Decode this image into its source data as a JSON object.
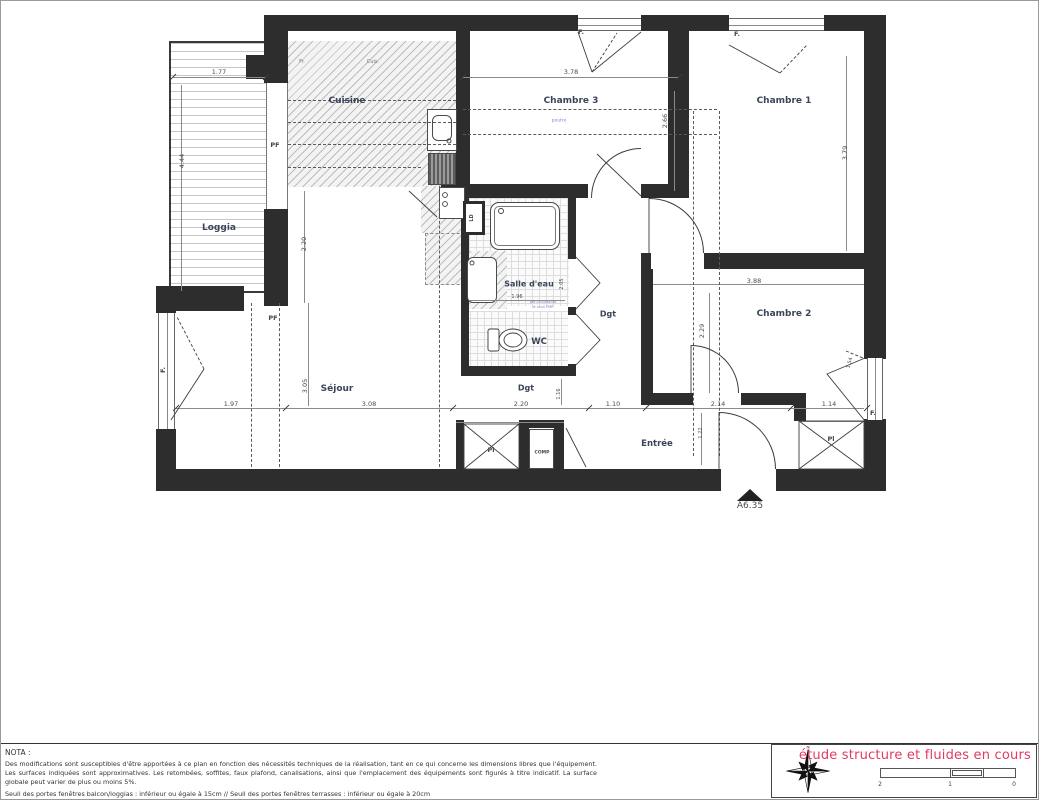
{
  "plan": {
    "labels": [
      {
        "n": "room-label-loggia",
        "t": "Loggia",
        "x": 218,
        "y": 227,
        "c": "room"
      },
      {
        "n": "room-label-cuisine",
        "t": "Cuisine",
        "x": 346,
        "y": 100,
        "c": "room"
      },
      {
        "n": "room-label-chambre3",
        "t": "Chambre 3",
        "x": 570,
        "y": 100,
        "c": "room"
      },
      {
        "n": "room-label-chambre1",
        "t": "Chambre 1",
        "x": 783,
        "y": 100,
        "c": "room"
      },
      {
        "n": "room-label-sejour",
        "t": "Séjour",
        "x": 336,
        "y": 388,
        "c": "room"
      },
      {
        "n": "room-label-salle-deau",
        "t": "Salle d'eau",
        "x": 528,
        "y": 283,
        "c": "room",
        "s": 8
      },
      {
        "n": "room-label-wc",
        "t": "WC",
        "x": 538,
        "y": 341,
        "c": "room",
        "s": 8.5
      },
      {
        "n": "room-label-chambre2",
        "t": "Chambre 2",
        "x": 783,
        "y": 313,
        "c": "room"
      },
      {
        "n": "room-label-entree",
        "t": "Entrée",
        "x": 656,
        "y": 443,
        "c": "room",
        "s": 8.5
      },
      {
        "n": "room-label-dgt-1",
        "t": "Dgt",
        "x": 525,
        "y": 387,
        "c": "room",
        "s": 8
      },
      {
        "n": "room-label-dgt-2",
        "t": "Dgt",
        "x": 607,
        "y": 313,
        "c": "room",
        "s": 8
      },
      {
        "n": "label-pf-1",
        "t": "PF",
        "x": 274,
        "y": 144,
        "c": "small"
      },
      {
        "n": "label-pf-2",
        "t": "PF",
        "x": 272,
        "y": 317,
        "c": "small"
      },
      {
        "n": "label-f-chambre3",
        "t": "F.",
        "x": 580,
        "y": 31,
        "c": "small"
      },
      {
        "n": "label-f-chambre1",
        "t": "F.",
        "x": 736,
        "y": 33,
        "c": "small"
      },
      {
        "n": "label-f-chambre2",
        "t": "F.",
        "x": 872,
        "y": 412,
        "c": "small"
      },
      {
        "n": "label-f-sejour",
        "t": "F.",
        "x": 162,
        "y": 369,
        "c": "small",
        "r": -90
      },
      {
        "n": "label-pl-1",
        "t": "Pl",
        "x": 490,
        "y": 449,
        "c": "small"
      },
      {
        "n": "label-pl-2",
        "t": "Pl",
        "x": 830,
        "y": 438,
        "c": "small"
      },
      {
        "n": "label-comp",
        "t": "COMP",
        "x": 541,
        "y": 452,
        "c": "small",
        "s": 4.5
      },
      {
        "n": "label-ld",
        "t": "LD",
        "x": 471,
        "y": 217,
        "c": "small",
        "s": 5,
        "r": -90
      },
      {
        "n": "label-fr",
        "t": "Fr.",
        "x": 301,
        "y": 61,
        "c": "tiny"
      },
      {
        "n": "label-cuis",
        "t": "Cuis.",
        "x": 372,
        "y": 61,
        "c": "tiny"
      },
      {
        "n": "label-poutre",
        "t": "poutre",
        "x": 558,
        "y": 120,
        "c": "tiny blue",
        "s": 4.5
      },
      {
        "n": "label-porte-note-1",
        "t": "pte coulissante",
        "x": 542,
        "y": 301,
        "c": "tiny blue",
        "s": 3.5
      },
      {
        "n": "label-porte-note-2",
        "t": "et seuil PMR",
        "x": 542,
        "y": 306,
        "c": "tiny blue",
        "s": 3.5
      },
      {
        "n": "label-apartment-ref",
        "t": "A6.35",
        "x": 749,
        "y": 505,
        "c": "dim",
        "s": 9
      },
      {
        "n": "dim-1-77",
        "t": "1.77",
        "x": 218,
        "y": 71,
        "c": "dim"
      },
      {
        "n": "dim-3-78",
        "t": "3.78",
        "x": 570,
        "y": 71,
        "c": "dim"
      },
      {
        "n": "dim-4-44",
        "t": "4.44",
        "x": 181,
        "y": 160,
        "c": "dim",
        "r": -90
      },
      {
        "n": "dim-2-20-cuisine",
        "t": "2.20",
        "x": 303,
        "y": 243,
        "c": "dim",
        "r": -90
      },
      {
        "n": "dim-3-05",
        "t": "3.05",
        "x": 304,
        "y": 385,
        "c": "dim",
        "r": -90
      },
      {
        "n": "dim-2-66",
        "t": "2.66",
        "x": 664,
        "y": 120,
        "c": "dim",
        "r": -90
      },
      {
        "n": "dim-3-79",
        "t": "3.79",
        "x": 844,
        "y": 152,
        "c": "dim",
        "r": -90
      },
      {
        "n": "dim-3-88",
        "t": "3.88",
        "x": 753,
        "y": 280,
        "c": "dim"
      },
      {
        "n": "dim-2-29",
        "t": "2.29",
        "x": 701,
        "y": 330,
        "c": "dim",
        "r": -90
      },
      {
        "n": "dim-1-97",
        "t": "1.97",
        "x": 230,
        "y": 403,
        "c": "dim"
      },
      {
        "n": "dim-3-08",
        "t": "3.08",
        "x": 368,
        "y": 403,
        "c": "dim"
      },
      {
        "n": "dim-2-20",
        "t": "2.20",
        "x": 520,
        "y": 403,
        "c": "dim"
      },
      {
        "n": "dim-1-10",
        "t": "1.10",
        "x": 612,
        "y": 403,
        "c": "dim"
      },
      {
        "n": "dim-2-14",
        "t": "2.14",
        "x": 717,
        "y": 403,
        "c": "dim"
      },
      {
        "n": "dim-1-14",
        "t": "1.14",
        "x": 828,
        "y": 403,
        "c": "dim"
      },
      {
        "n": "dim-1-16",
        "t": "1.16",
        "x": 558,
        "y": 393,
        "c": "dim",
        "r": -90,
        "s": 5
      },
      {
        "n": "dim-1-22",
        "t": "1.22",
        "x": 700,
        "y": 432,
        "c": "dim",
        "r": -90,
        "s": 5
      },
      {
        "n": "dim-1-96",
        "t": "1.96",
        "x": 516,
        "y": 296,
        "c": "dim",
        "s": 5
      },
      {
        "n": "dim-2-05",
        "t": "2.05",
        "x": 561,
        "y": 283,
        "c": "dim",
        "r": -90,
        "s": 5
      },
      {
        "n": "dim-1-54",
        "t": "1.54",
        "x": 849,
        "y": 362,
        "c": "dim",
        "r": -75,
        "s": 5
      }
    ]
  },
  "nota": {
    "title": "NOTA :",
    "body": "Des modifications sont susceptibles d'être apportées à ce plan en fonction des nécessités techniques de la réalisation, tant en ce qui concerne les dimensions libres que l'équipement. Les surfaces indiquées sont approximatives. Les retombées, soffites, faux plafond, canalisations, ainsi que l'emplacement des équipements sont figurés à titre indicatif. La surface globale peut varier de plus ou moins 5%.",
    "seuil": "Seuil des portes fenêtres balcon/loggias : inférieur ou égale à 15cm // Seuil des portes fenêtres terrasses :  inférieur ou égale à 20cm"
  },
  "title_block": {
    "status": "étude structure et fluides en cours",
    "status_color": "#e23a64",
    "compass_north": "N",
    "scale_ticks": [
      "2",
      "1",
      "0"
    ]
  }
}
